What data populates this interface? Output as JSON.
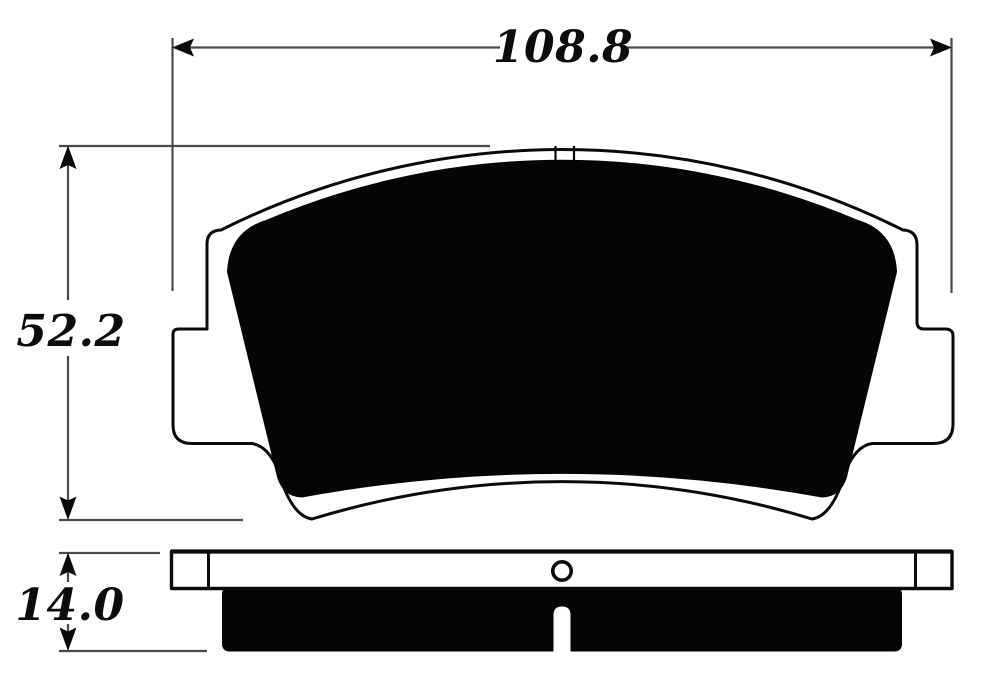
{
  "dimensions": {
    "width": {
      "label": "108.8",
      "value": 108.8,
      "orientation": "horizontal"
    },
    "height": {
      "label": "52.2",
      "value": 52.2,
      "orientation": "vertical"
    },
    "thickness": {
      "label": "14.0",
      "value": 14.0,
      "orientation": "vertical"
    }
  },
  "colors": {
    "background": "#ffffff",
    "outline": "#0a0a0a",
    "pad_fill": "#050505",
    "dimension_lines": "#4a4a4a",
    "dimension_text": "#0c0c0c"
  },
  "views": {
    "front": {
      "features": [
        "backing-plate-outline",
        "friction-material",
        "left-abutment-ear",
        "right-abutment-ear",
        "top-center-notch"
      ]
    },
    "side": {
      "features": [
        "backing-plate-strip",
        "left-end-tab",
        "right-end-tab",
        "mounting-hole",
        "friction-block",
        "center-wear-slot"
      ]
    }
  }
}
